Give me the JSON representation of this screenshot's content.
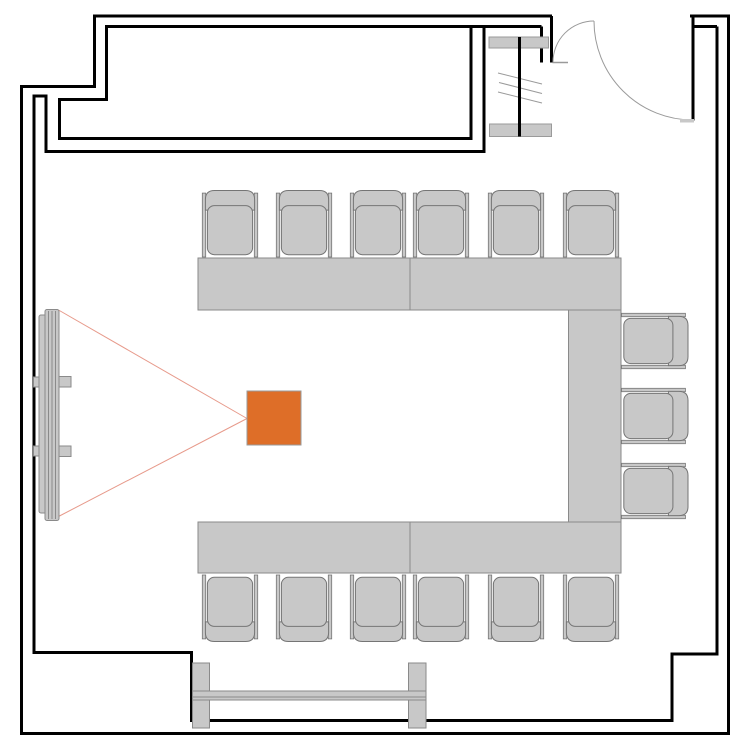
{
  "diagram": {
    "type": "floor-plan",
    "description": "Meeting room floor plan: U-shaped conference table seating 15, ceiling projector with projection cone onto a wall screen, entrance door with swing arcs, window partition, top alcove and bottom railing",
    "background": "#ffffff",
    "width": 750,
    "height": 750
  },
  "colors": {
    "wall": "#000000",
    "furniture_fill": "#c8c8c8",
    "furniture_stroke": "#8a8a8a",
    "chair_stroke": "#757575",
    "projector_fill": "#de6e28",
    "projector_stroke": "#9a9a9a",
    "projection_line": "#e79a8b",
    "door_line": "#9a9a9a",
    "glazing_line": "#9a9a9a",
    "sill_fill": "#c8c8c8",
    "sill_stroke": "#9a9a9a"
  },
  "walls": {
    "stroke_width": 3,
    "outer": "M552,16 L94.5,16 L94.5,86.5 L21.5,86.5 L21.5,733.5 L728.5,733.5 L728.5,16 L690,16",
    "inner": [
      {
        "name": "alcove-interior-wall",
        "d": "M541.5,26.5 L106.5,26.5 L106.5,99.5 L59.5,99.5 L59.5,138.5 L471,138.5 L471,26.5"
      },
      {
        "name": "room-inner-wall",
        "d": "M484,26.5 L484,151.5 L46,151.5 L46,96 L34,96 L34,652.5 L191.5,652.5 L191.5,720.5 L672,720.5 L672,654 L717,654 L717,26.5"
      },
      {
        "name": "door-left-jamb-inner",
        "d": "M541.5,26.5 L541.5,62.5"
      },
      {
        "name": "door-left-jamb-outer",
        "d": "M551.5,16 L551.5,62.5"
      },
      {
        "name": "door-right-jamb",
        "d": "M693,16 L693,120.5"
      },
      {
        "name": "door-right-jamb-connector",
        "d": "M693,26.5 L717,26.5"
      }
    ]
  },
  "window": {
    "mullion": {
      "x": 519.5,
      "y1": 37,
      "y2": 136.5,
      "width": 3
    },
    "sills": [
      {
        "x": 489,
        "y": 37,
        "w": 59.5,
        "h": 11
      },
      {
        "x": 489.5,
        "y": 124,
        "w": 62,
        "h": 12.5
      }
    ],
    "glazing": [
      [
        498,
        73,
        542,
        84
      ],
      [
        499,
        82.5,
        542,
        93.5
      ],
      [
        498,
        92,
        542,
        103
      ]
    ]
  },
  "door": {
    "threshold": [
      552.5,
      62.5,
      568,
      62.5
    ],
    "swing_arcs": [
      "M553,62.5 A41,41 0 0 1 594,21",
      "M594,21 A99,99 0 0 0 693,120"
    ],
    "stop": {
      "x": 680,
      "y": 119,
      "w": 14,
      "h": 3.5
    }
  },
  "projection": {
    "apex": [
      247,
      418.5
    ],
    "beam_ends": [
      [
        58.5,
        310
      ],
      [
        58.5,
        516.5
      ]
    ]
  },
  "screen": {
    "back": {
      "x": 39,
      "y": 315,
      "w": 9,
      "h": 198,
      "rx": 2
    },
    "case": {
      "x": 45,
      "y": 309.5,
      "w": 14,
      "h": 211,
      "rx": 2
    },
    "case_lines_x": [
      48.5,
      52,
      55.5
    ],
    "brackets": [
      {
        "x": 33.5,
        "y": 377,
        "w": 8,
        "h": 10
      },
      {
        "x": 33.5,
        "y": 446,
        "w": 8,
        "h": 10
      },
      {
        "x": 59,
        "y": 376.5,
        "w": 12,
        "h": 10.5
      },
      {
        "x": 59,
        "y": 446,
        "w": 12,
        "h": 10.5
      }
    ]
  },
  "projector": {
    "x": 247,
    "y": 391,
    "w": 54,
    "h": 54
  },
  "tables": [
    {
      "name": "table-top-left",
      "x": 198,
      "y": 258,
      "w": 212,
      "h": 52
    },
    {
      "name": "table-top-right",
      "x": 410,
      "y": 258,
      "w": 211,
      "h": 52
    },
    {
      "name": "table-right",
      "x": 568.5,
      "y": 310,
      "w": 52.5,
      "h": 212
    },
    {
      "name": "table-bottom-left",
      "x": 198,
      "y": 522,
      "w": 212,
      "h": 51
    },
    {
      "name": "table-bottom-right",
      "x": 410,
      "y": 522,
      "w": 211,
      "h": 51
    }
  ],
  "chair_glyph": {
    "rails": [
      [
        -27.7,
        -30.9,
        3.4,
        63.9
      ],
      [
        24.3,
        -30.9,
        3.4,
        63.9
      ]
    ],
    "backrest": "M-24.6,-13.9 L-24.6,-24.4 Q-24.6,-33.5 -15.6,-33.5 L15.6,-33.5 Q24.6,-33.5 24.6,-24.4 L24.6,-13.9 Z",
    "seat": [
      -22.6,
      -18.4,
      45.2,
      49.1,
      7
    ]
  },
  "chairs": {
    "count": 15,
    "top": {
      "y": 224,
      "rotation": 0,
      "xs": [
        230,
        304,
        378,
        441,
        516,
        591
      ]
    },
    "bottom": {
      "y": 608,
      "rotation": 180,
      "xs": [
        230,
        304,
        378,
        441,
        516,
        591
      ]
    },
    "right": {
      "x": 654.5,
      "rotation": 90,
      "ys": [
        341,
        416,
        491
      ]
    }
  },
  "railing": {
    "posts": [
      {
        "x": 192.5,
        "y": 663,
        "w": 17,
        "h": 65
      },
      {
        "x": 408.5,
        "y": 663,
        "w": 17.5,
        "h": 65
      }
    ],
    "rail": {
      "x": 192.5,
      "y": 691,
      "w": 233.5,
      "h": 9
    },
    "rail_inner_line_y": 697
  }
}
